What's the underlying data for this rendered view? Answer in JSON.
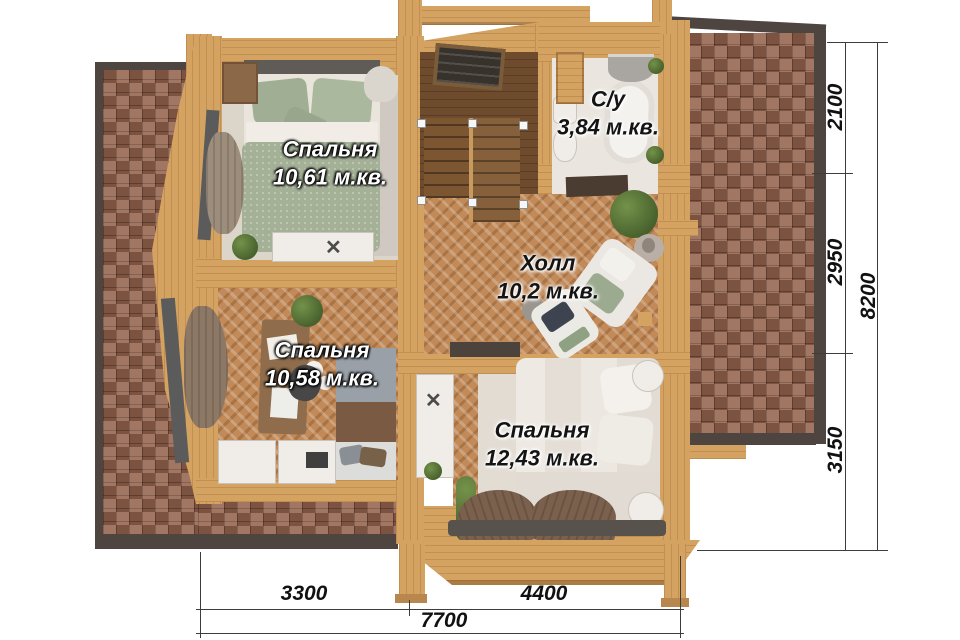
{
  "plan": {
    "rooms": [
      {
        "name": "Спальня",
        "area": "10,61 м.кв."
      },
      {
        "name": "Спальня",
        "area": "10,58 м.кв."
      },
      {
        "name": "Спальня",
        "area": "12,43 м.кв."
      },
      {
        "name": "Холл",
        "area": "10,2 м.кв."
      },
      {
        "name": "С/у",
        "area": "3,84 м.кв."
      }
    ]
  },
  "dimensions": {
    "vertical": {
      "segments": [
        "2100",
        "2950",
        "3150"
      ],
      "total": "8200"
    },
    "horizontal": {
      "segments": [
        "3300",
        "4400"
      ],
      "total": "7700"
    }
  },
  "icons": {
    "cross": "✕"
  },
  "colors": {
    "wood": "#d4a261",
    "roof_brick": "#8f604e",
    "roof_edge": "#4e4540",
    "dimension_line": "#3d3d3d"
  }
}
